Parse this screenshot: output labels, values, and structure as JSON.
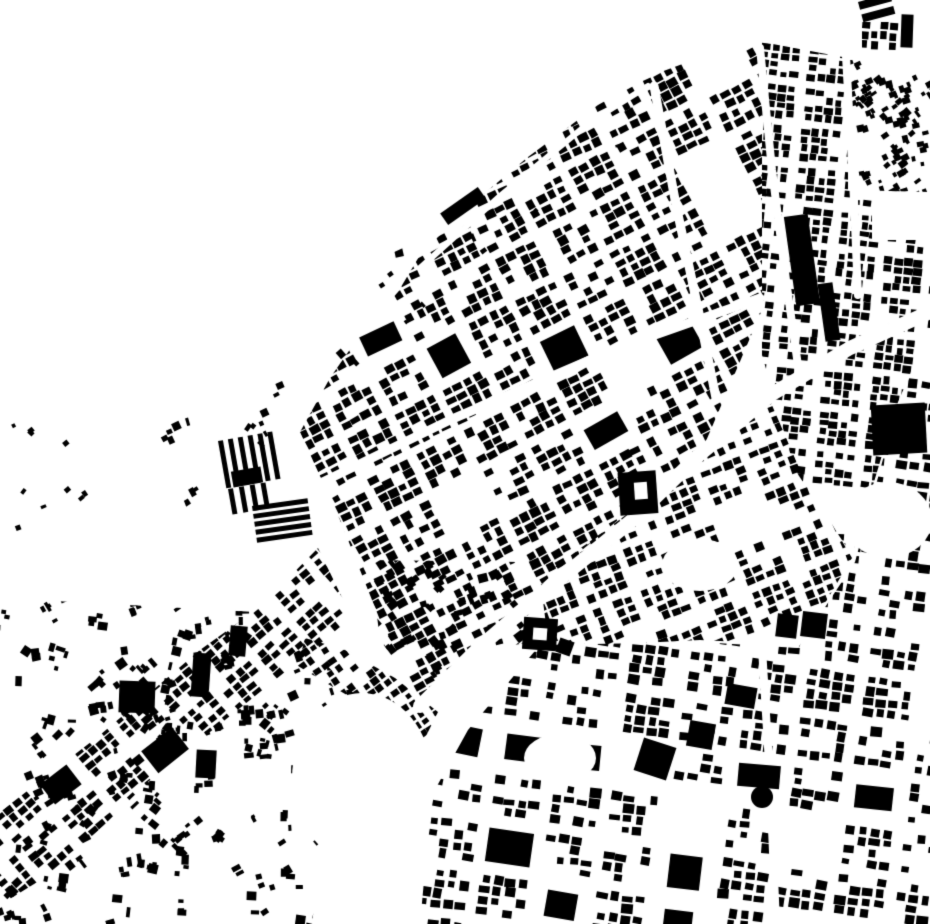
{
  "map": {
    "type": "figure-ground-city-map",
    "width": 930,
    "height": 924,
    "colors": {
      "background": "#ffffff",
      "building": "#000000",
      "street": "#ffffff"
    },
    "districts": [
      {
        "name": "central-grid",
        "seed": 11,
        "angle": -27,
        "block": [
          46,
          40
        ],
        "street": [
          7,
          6
        ],
        "lot": [
          12,
          10
        ],
        "density": 0.78,
        "fill": [
          0.55,
          0.92
        ],
        "jitter": 0.1,
        "big_chance": 0.05,
        "empty_chance": 0.05,
        "polygon": [
          [
            398,
            292
          ],
          [
            420,
            255
          ],
          [
            468,
            207
          ],
          [
            528,
            157
          ],
          [
            598,
            105
          ],
          [
            650,
            76
          ],
          [
            715,
            52
          ],
          [
            762,
            46
          ],
          [
            762,
            310
          ],
          [
            700,
            455
          ],
          [
            630,
            510
          ],
          [
            552,
            575
          ],
          [
            482,
            638
          ],
          [
            420,
            700
          ],
          [
            380,
            620
          ],
          [
            340,
            520
          ],
          [
            300,
            432
          ],
          [
            330,
            378
          ],
          [
            360,
            335
          ]
        ]
      },
      {
        "name": "right-vertical-grid",
        "seed": 22,
        "angle": 6,
        "block": [
          40,
          34
        ],
        "street": [
          8,
          6
        ],
        "lot": [
          11,
          9
        ],
        "density": 0.82,
        "fill": [
          0.55,
          0.95
        ],
        "jitter": 0.07,
        "big_chance": 0.04,
        "empty_chance": 0.05,
        "polygon": [
          [
            762,
            42
          ],
          [
            848,
            58
          ],
          [
            848,
            190
          ],
          [
            872,
            196
          ],
          [
            872,
            240
          ],
          [
            930,
            240
          ],
          [
            930,
            328
          ],
          [
            898,
            402
          ],
          [
            852,
            555
          ],
          [
            795,
            470
          ],
          [
            762,
            355
          ]
        ]
      },
      {
        "name": "mid-band-below-avenue",
        "seed": 31,
        "angle": -22,
        "block": [
          44,
          38
        ],
        "street": [
          7,
          6
        ],
        "lot": [
          12,
          10
        ],
        "density": 0.72,
        "fill": [
          0.55,
          0.9
        ],
        "jitter": 0.1,
        "big_chance": 0.05,
        "empty_chance": 0.07,
        "polygon": [
          [
            540,
            578
          ],
          [
            630,
            512
          ],
          [
            700,
            458
          ],
          [
            768,
            396
          ],
          [
            800,
            470
          ],
          [
            852,
            558
          ],
          [
            800,
            645
          ],
          [
            700,
            640
          ],
          [
            600,
            645
          ],
          [
            548,
            640
          ]
        ]
      },
      {
        "name": "south-east-grid",
        "seed": 32,
        "angle": 8,
        "block": [
          50,
          42
        ],
        "street": [
          9,
          8
        ],
        "lot": [
          13,
          11
        ],
        "density": 0.62,
        "fill": [
          0.5,
          0.95
        ],
        "jitter": 0.12,
        "big_chance": 0.1,
        "empty_chance": 0.08,
        "polygon": [
          [
            420,
            924
          ],
          [
            432,
            795
          ],
          [
            468,
            730
          ],
          [
            540,
            645
          ],
          [
            700,
            642
          ],
          [
            798,
            648
          ],
          [
            855,
            562
          ],
          [
            898,
            404
          ],
          [
            930,
            330
          ],
          [
            930,
            924
          ]
        ]
      },
      {
        "name": "southwest-diagonal-band",
        "seed": 44,
        "angle": -40,
        "block": [
          44,
          36
        ],
        "street": [
          7,
          6
        ],
        "lot": [
          11,
          9
        ],
        "density": 0.78,
        "fill": [
          0.55,
          0.9
        ],
        "jitter": 0.09,
        "big_chance": 0.04,
        "empty_chance": 0.06,
        "polygon": [
          [
            0,
            812
          ],
          [
            100,
            735
          ],
          [
            200,
            650
          ],
          [
            260,
            607
          ],
          [
            318,
            548
          ],
          [
            352,
            618
          ],
          [
            250,
            700
          ],
          [
            150,
            780
          ],
          [
            60,
            868
          ],
          [
            0,
            905
          ]
        ]
      },
      {
        "name": "top-right-corner-cluster",
        "seed": 77,
        "angle": 4,
        "block": [
          36,
          30
        ],
        "street": [
          4,
          4
        ],
        "lot": [
          10,
          9
        ],
        "density": 0.92,
        "fill": [
          0.6,
          0.95
        ],
        "jitter": 0.04,
        "big_chance": 0,
        "empty_chance": 0,
        "polygon": [
          [
            862,
            22
          ],
          [
            900,
            22
          ],
          [
            900,
            54
          ],
          [
            862,
            54
          ]
        ]
      },
      {
        "name": "curved-arc-band",
        "seed": 99,
        "angle": -35,
        "block": [
          36,
          26
        ],
        "street": [
          5,
          5
        ],
        "lot": [
          9,
          8
        ],
        "density": 0.85,
        "fill": [
          0.55,
          0.9
        ],
        "jitter": 0.12,
        "big_chance": 0,
        "empty_chance": 0.04,
        "polygon": [
          [
            305,
            638
          ],
          [
            345,
            650
          ],
          [
            395,
            678
          ],
          [
            438,
            712
          ],
          [
            422,
            744
          ],
          [
            376,
            712
          ],
          [
            328,
            684
          ],
          [
            298,
            666
          ]
        ]
      }
    ],
    "scatters": [
      {
        "name": "northwest-coast-scatter",
        "seed": 5,
        "count": 60,
        "size": [
          3,
          9
        ],
        "angle": -35,
        "angle_spread": 40,
        "cluster": 4,
        "polygon": [
          [
            155,
            425
          ],
          [
            300,
            295
          ],
          [
            425,
            238
          ],
          [
            540,
            148
          ],
          [
            648,
            78
          ],
          [
            658,
            114
          ],
          [
            545,
            205
          ],
          [
            432,
            300
          ],
          [
            335,
            392
          ],
          [
            242,
            482
          ],
          [
            192,
            522
          ]
        ]
      },
      {
        "name": "bottom-left-scatter",
        "seed": 6,
        "count": 130,
        "size": [
          3,
          10
        ],
        "angle": -20,
        "angle_spread": 70,
        "cluster": 5,
        "polygon": [
          [
            0,
            598
          ],
          [
            255,
            612
          ],
          [
            318,
            656
          ],
          [
            360,
            700
          ],
          [
            330,
            770
          ],
          [
            312,
            924
          ],
          [
            0,
            924
          ]
        ]
      },
      {
        "name": "right-edge-scatter",
        "seed": 7,
        "count": 42,
        "size": [
          3,
          8
        ],
        "angle": -25,
        "angle_spread": 30,
        "cluster": 3,
        "polygon": [
          [
            850,
            60
          ],
          [
            930,
            62
          ],
          [
            930,
            192
          ],
          [
            850,
            190
          ]
        ]
      },
      {
        "name": "south-central-scatter",
        "seed": 8,
        "count": 45,
        "size": [
          4,
          10
        ],
        "angle": -30,
        "angle_spread": 25,
        "cluster": 3,
        "polygon": [
          [
            370,
            560
          ],
          [
            520,
            562
          ],
          [
            545,
            640
          ],
          [
            470,
            652
          ],
          [
            425,
            700
          ],
          [
            380,
            640
          ]
        ]
      },
      {
        "name": "far-left-specks",
        "seed": 9,
        "count": 12,
        "size": [
          3,
          6
        ],
        "angle": -30,
        "angle_spread": 40,
        "cluster": 2,
        "polygon": [
          [
            0,
            390
          ],
          [
            70,
            390
          ],
          [
            120,
            460
          ],
          [
            60,
            540
          ],
          [
            0,
            540
          ]
        ]
      }
    ],
    "clearings": [
      {
        "name": "southwest-empty-bulge",
        "cx": 362,
        "cy": 778,
        "rx": 70,
        "ry": 85
      },
      {
        "name": "right-mid-clearing",
        "cx": 888,
        "cy": 520,
        "rx": 44,
        "ry": 38
      },
      {
        "name": "center-south-clearing",
        "cx": 700,
        "cy": 565,
        "rx": 38,
        "ry": 26
      },
      {
        "name": "lower-center-clearing",
        "cx": 560,
        "cy": 758,
        "rx": 36,
        "ry": 24
      }
    ],
    "avenues": [
      {
        "name": "grand-diagonal-avenue",
        "width": 14,
        "points": [
          [
            930,
            312
          ],
          [
            850,
            348
          ],
          [
            772,
            394
          ],
          [
            698,
            456
          ],
          [
            630,
            522
          ],
          [
            552,
            585
          ],
          [
            482,
            645
          ],
          [
            420,
            706
          ]
        ]
      },
      {
        "name": "north-south-street-a",
        "width": 9,
        "points": [
          [
            654,
            86
          ],
          [
            676,
            205
          ],
          [
            700,
            318
          ],
          [
            716,
            398
          ]
        ]
      },
      {
        "name": "north-south-street-b",
        "width": 8,
        "points": [
          [
            760,
            48
          ],
          [
            772,
            170
          ],
          [
            786,
            280
          ],
          [
            800,
            380
          ]
        ]
      },
      {
        "name": "north-south-street-c",
        "width": 8,
        "points": [
          [
            846,
            56
          ],
          [
            854,
            200
          ],
          [
            858,
            295
          ]
        ]
      },
      {
        "name": "central-cross-street",
        "width": 9,
        "points": [
          [
            298,
            494
          ],
          [
            450,
            420
          ],
          [
            618,
            348
          ],
          [
            760,
            298
          ]
        ]
      },
      {
        "name": "coast-road",
        "width": 6,
        "points": [
          [
            420,
            268
          ],
          [
            500,
            196
          ],
          [
            590,
            122
          ],
          [
            648,
            86
          ]
        ]
      },
      {
        "name": "south-vertical-street",
        "width": 8,
        "points": [
          [
            762,
            648
          ],
          [
            770,
            780
          ],
          [
            776,
            924
          ]
        ]
      }
    ],
    "landmarks": [
      {
        "name": "big-black-square-right-edge",
        "type": "rect",
        "cx": 899,
        "cy": 429,
        "w": 54,
        "h": 50,
        "rot": -3
      },
      {
        "name": "long-slab-upper",
        "type": "rect",
        "cx": 802,
        "cy": 260,
        "w": 24,
        "h": 90,
        "rot": -8
      },
      {
        "name": "long-slab-lower",
        "type": "rect",
        "cx": 829,
        "cy": 312,
        "w": 15,
        "h": 58,
        "rot": -8
      },
      {
        "name": "twin-square-west",
        "type": "rect",
        "cx": 787,
        "cy": 626,
        "w": 21,
        "h": 23,
        "rot": 7
      },
      {
        "name": "twin-square-east",
        "type": "rect",
        "cx": 814,
        "cy": 625,
        "w": 25,
        "h": 25,
        "rot": 7
      },
      {
        "name": "round-building",
        "type": "circle",
        "cx": 762,
        "cy": 797,
        "r": 11
      },
      {
        "name": "wide-block-near-circle",
        "type": "rect",
        "cx": 759,
        "cy": 776,
        "w": 42,
        "h": 23,
        "rot": 5
      },
      {
        "name": "large-block-southcenter",
        "type": "rect",
        "cx": 655,
        "cy": 759,
        "w": 34,
        "h": 34,
        "rot": 18
      },
      {
        "name": "courtyard-building-south",
        "type": "ring",
        "cx": 540,
        "cy": 634,
        "w": 34,
        "h": 32,
        "hw": 14,
        "hh": 12,
        "hx": 0,
        "hy": 0,
        "rot": 4
      },
      {
        "name": "courtyard-building-center",
        "type": "ring",
        "cx": 638,
        "cy": 493,
        "w": 38,
        "h": 43,
        "hw": 13,
        "hh": 17,
        "hx": 3,
        "hy": -2,
        "rot": -4
      },
      {
        "name": "industrial-stripes-vertical",
        "type": "bars",
        "x": 218,
        "y": 441,
        "dir": "v",
        "count": 6,
        "bw": 5,
        "bh": 48,
        "gap": 5,
        "rot": -10
      },
      {
        "name": "industrial-stripes-vertical-small",
        "type": "bars",
        "x": 228,
        "y": 489,
        "dir": "v",
        "count": 4,
        "bw": 5,
        "bh": 26,
        "gap": 6,
        "rot": -10
      },
      {
        "name": "industrial-block-solid",
        "type": "rect",
        "cx": 247,
        "cy": 477,
        "w": 30,
        "h": 16,
        "rot": -10
      },
      {
        "name": "industrial-stripes-horizontal",
        "type": "bars",
        "x": 252,
        "y": 506,
        "dir": "h",
        "count": 5,
        "bw": 56,
        "bh": 5,
        "gap": 3,
        "rot": -8
      },
      {
        "name": "top-right-slanted-bars",
        "type": "bars",
        "x": 858,
        "y": 2,
        "dir": "h",
        "count": 2,
        "bw": 33,
        "bh": 8,
        "gap": 5,
        "rot": -15
      },
      {
        "name": "top-right-tall-block",
        "type": "rect",
        "cx": 907,
        "cy": 31,
        "w": 12,
        "h": 33,
        "rot": 2
      },
      {
        "name": "southeast-square-block",
        "type": "rect",
        "cx": 701,
        "cy": 735,
        "w": 26,
        "h": 26,
        "rot": 10
      },
      {
        "name": "southeast-wide-block",
        "type": "rect",
        "cx": 741,
        "cy": 696,
        "w": 30,
        "h": 21,
        "rot": 10
      },
      {
        "name": "west-large-block",
        "type": "rect",
        "cx": 137,
        "cy": 697,
        "w": 36,
        "h": 32,
        "rot": 2
      },
      {
        "name": "west-tall-slab",
        "type": "rect",
        "cx": 201,
        "cy": 675,
        "w": 18,
        "h": 44,
        "rot": 4
      },
      {
        "name": "west-small-slab",
        "type": "rect",
        "cx": 238,
        "cy": 641,
        "w": 17,
        "h": 30,
        "rot": 5
      },
      {
        "name": "west-lower-slab",
        "type": "rect",
        "cx": 206,
        "cy": 764,
        "w": 20,
        "h": 28,
        "rot": 3
      },
      {
        "name": "pentagon-block",
        "type": "rect",
        "cx": 565,
        "cy": 647,
        "w": 15,
        "h": 15,
        "rot": 20
      },
      {
        "name": "coast-long-bar",
        "type": "rect",
        "cx": 463,
        "cy": 206,
        "w": 46,
        "h": 14,
        "rot": -35
      }
    ]
  }
}
